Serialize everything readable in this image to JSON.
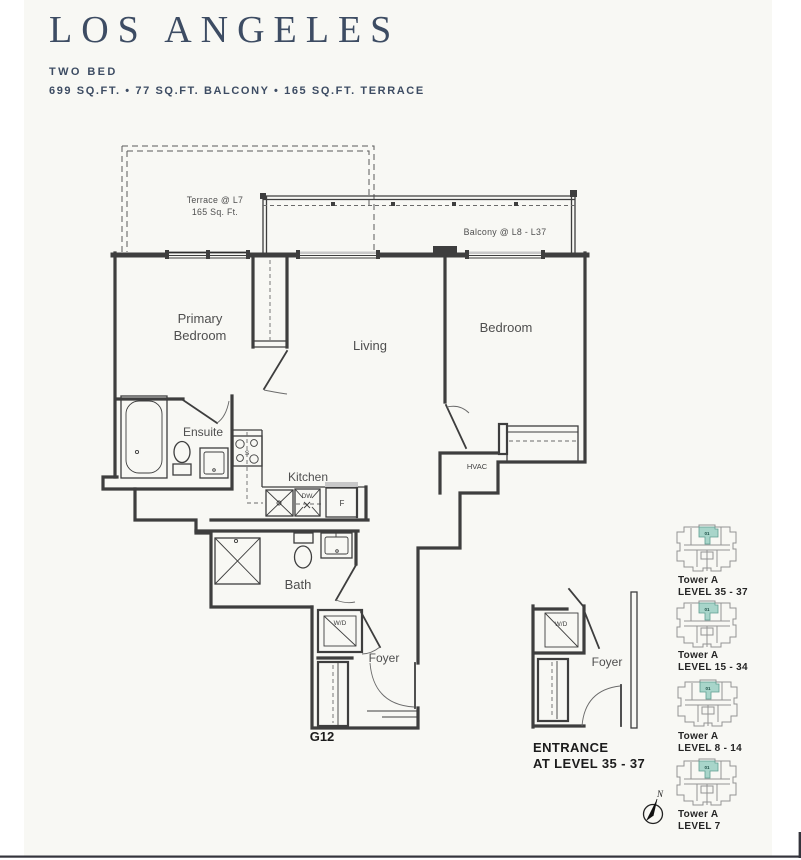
{
  "header": {
    "title": "LOS ANGELES",
    "plan_type": "TWO BED",
    "specs": "699 SQ.FT. • 77 SQ.FT. BALCONY • 165 SQ.FT. TERRACE"
  },
  "floorplan": {
    "terrace_note": [
      "Terrace @ L7",
      "165 Sq. Ft."
    ],
    "balcony_note": "Balcony @ L8 - L37",
    "rooms": {
      "primary_bedroom": [
        "Primary",
        "Bedroom"
      ],
      "living": "Living",
      "bedroom": "Bedroom",
      "ensuite": "Ensuite",
      "kitchen": "Kitchen",
      "bath": "Bath",
      "foyer": "Foyer",
      "hvac": "HVAC"
    },
    "fixtures": {
      "washer_dryer": "W/D",
      "dishwasher": "DW",
      "fridge": "F",
      "stove": "S"
    },
    "unit_number": "G12"
  },
  "entrance_detail": {
    "washer_dryer": "W/D",
    "foyer": "Foyer",
    "caption": [
      "ENTRANCE",
      "AT LEVEL 35 - 37"
    ]
  },
  "keyplans": [
    {
      "tower": "Tower A",
      "level": "LEVEL 35 - 37",
      "unit": "01"
    },
    {
      "tower": "Tower A",
      "level": "LEVEL 15 - 34",
      "unit": "01"
    },
    {
      "tower": "Tower A",
      "level": "LEVEL 8 - 14",
      "unit": "01"
    },
    {
      "tower": "Tower A",
      "level": "LEVEL 7",
      "unit": "01"
    }
  ],
  "compass": {
    "north": "N"
  },
  "colors": {
    "accent_navy": "#3d4c63",
    "highlight_teal": "#a8d5ca",
    "line": "#3e3e3e"
  }
}
